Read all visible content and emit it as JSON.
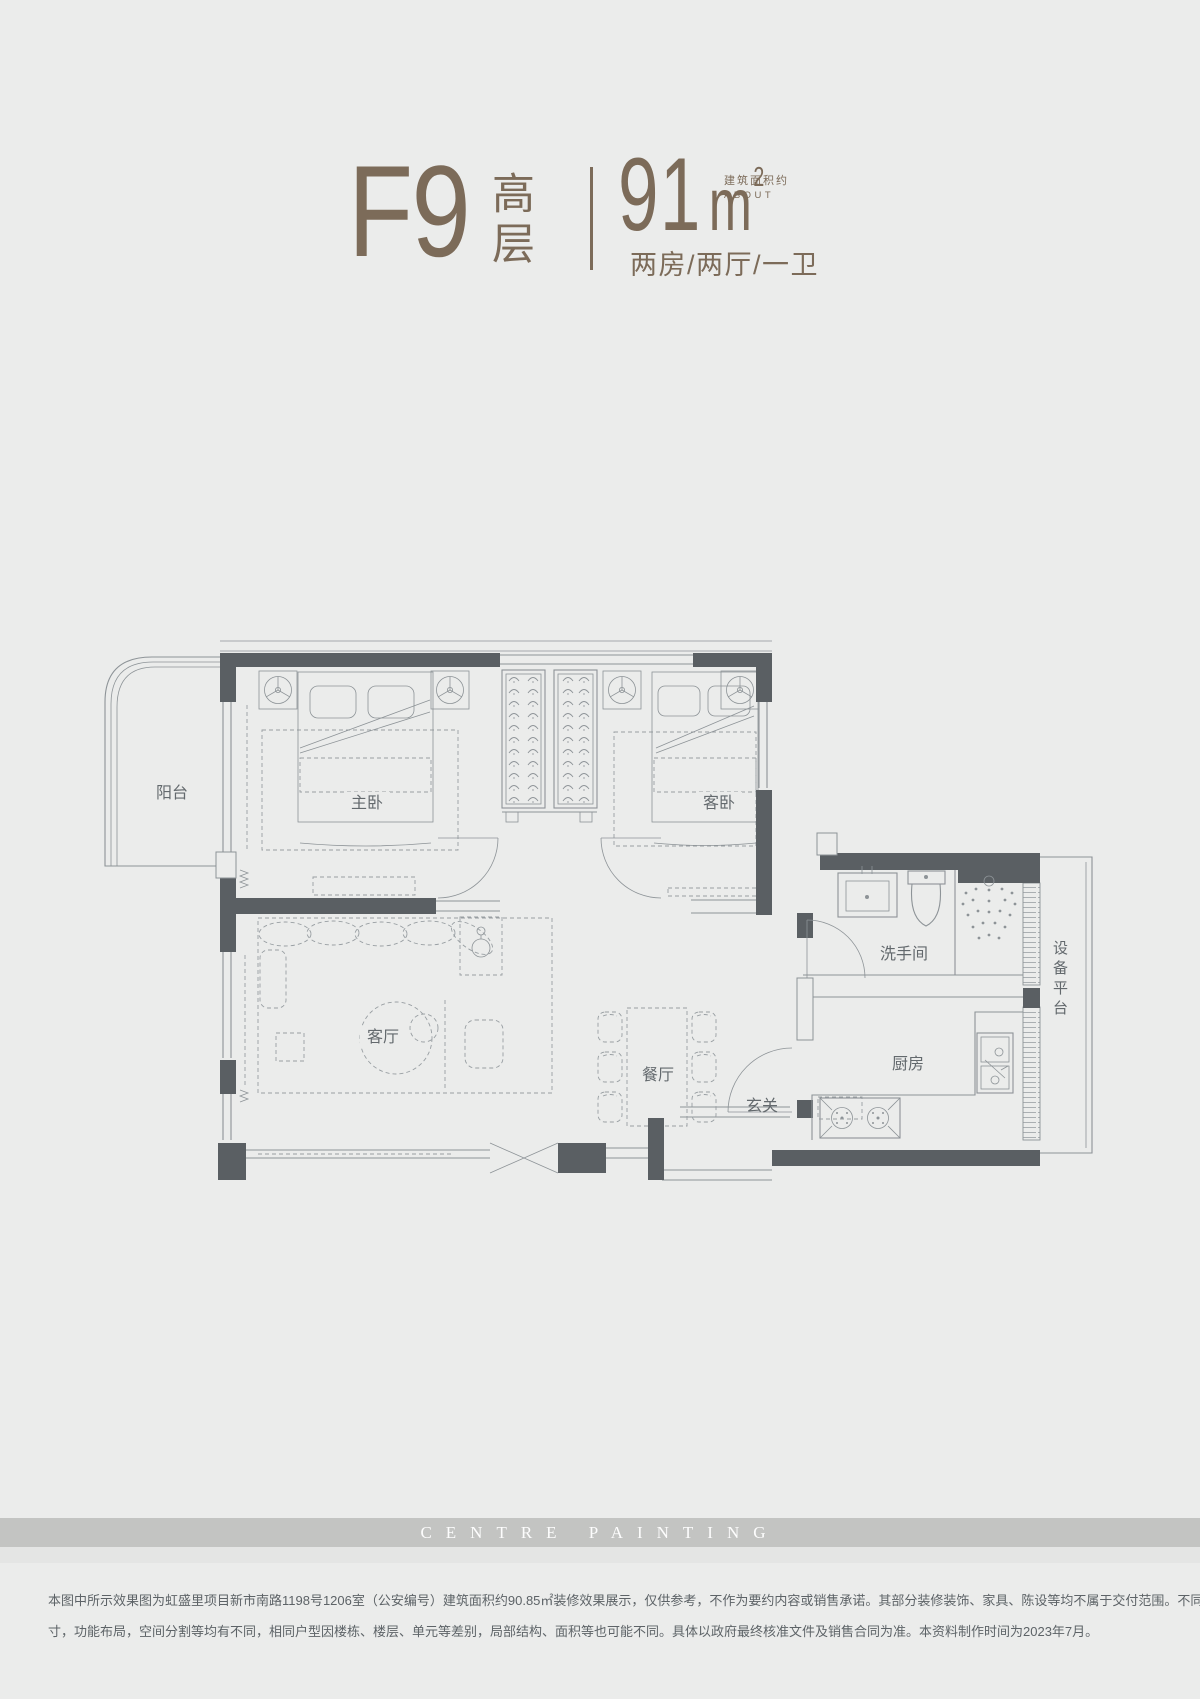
{
  "header": {
    "plan_code": "F9",
    "plan_type": "高层",
    "area_value": "91",
    "area_unit": "m",
    "area_sup": "2",
    "area_note_cn": "建筑面积约",
    "area_note_en": "ABOUT",
    "layout_desc": "两房/两厅/一卫",
    "accent_color": "#7c6b59"
  },
  "floorplan": {
    "rooms": {
      "balcony": "阳台",
      "master_bedroom": "主卧",
      "guest_bedroom": "客卧",
      "living_room": "客厅",
      "dining_room": "餐厅",
      "entry": "玄关",
      "kitchen": "厨房",
      "bathroom": "洗手间",
      "equipment_platform": "设备平台"
    },
    "wall_color": "#5a5f63",
    "line_color": "#8d9397"
  },
  "watermark": {
    "text": "CENTRE PAINTING"
  },
  "disclaimer": {
    "line1": "本图中所示效果图为虹盛里项目新市南路1198号1206室（公安编号）建筑面积约90.85㎡装修效果展示，仅供参考，不作为要约内容或销售承诺。其部分装修装饰、家具、陈设等均不属于交付范围。不同户型的面积尺",
    "line2": "寸，功能布局，空间分割等均有不同，相同户型因楼栋、楼层、单元等差别，局部结构、面积等也可能不同。具体以政府最终核准文件及销售合同为准。本资料制作时间为2023年7月。"
  }
}
